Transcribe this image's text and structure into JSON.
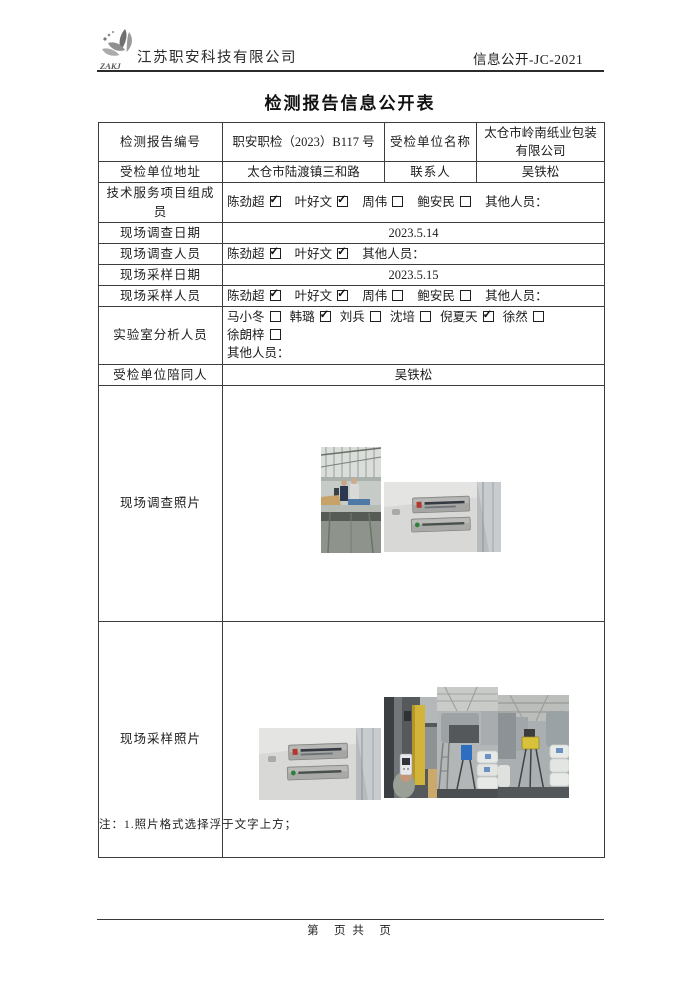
{
  "header": {
    "logo_text": "ZAKJ",
    "company": "江苏职安科技有限公司",
    "doc_code": "信息公开-JC-2021"
  },
  "title": "检测报告信息公开表",
  "table": {
    "row1": {
      "c1": "检测报告编号",
      "c2": "职安职检（2023）B117 号",
      "c3": "受检单位名称",
      "c4": "太仓市岭南纸业包装有限公司"
    },
    "row2": {
      "c1": "受检单位地址",
      "c2": "太仓市陆渡镇三和路",
      "c3": "联系人",
      "c4": "吴铁松"
    },
    "tech_team": {
      "label": "技术服务项目组成员",
      "members": [
        {
          "name": "陈劲超",
          "checked": true
        },
        {
          "name": "叶好文",
          "checked": true
        },
        {
          "name": "周伟",
          "checked": false
        },
        {
          "name": "鲍安民",
          "checked": false
        }
      ],
      "other_label": "其他人员："
    },
    "survey_date": {
      "label": "现场调查日期",
      "value": "2023.5.14"
    },
    "survey_staff": {
      "label": "现场调查人员",
      "members": [
        {
          "name": "陈劲超",
          "checked": true
        },
        {
          "name": "叶好文",
          "checked": true
        }
      ],
      "other_label": "其他人员："
    },
    "sampling_date": {
      "label": "现场采样日期",
      "value": "2023.5.15"
    },
    "sampling_staff": {
      "label": "现场采样人员",
      "members": [
        {
          "name": "陈劲超",
          "checked": true
        },
        {
          "name": "叶好文",
          "checked": true
        },
        {
          "name": "周伟",
          "checked": false
        },
        {
          "name": "鲍安民",
          "checked": false
        }
      ],
      "other_label": "其他人员："
    },
    "lab_staff": {
      "label": "实验室分析人员",
      "members": [
        {
          "name": "马小冬",
          "checked": false
        },
        {
          "name": "韩璐",
          "checked": true
        },
        {
          "name": "刘兵",
          "checked": false
        },
        {
          "name": "沈培",
          "checked": false
        },
        {
          "name": "倪夏天",
          "checked": true
        },
        {
          "name": "徐然",
          "checked": false
        },
        {
          "name": "徐朗梓",
          "checked": false
        }
      ],
      "other_label": "其他人员："
    },
    "escort": {
      "label": "受检单位陪同人",
      "value": "吴铁松"
    },
    "survey_photos": {
      "label": "现场调查照片"
    },
    "sampling_photos": {
      "label": "现场采样照片"
    }
  },
  "note": "注：1.照片格式选择浮于文字上方；",
  "footer": {
    "page_text": "第　页 共　页"
  }
}
